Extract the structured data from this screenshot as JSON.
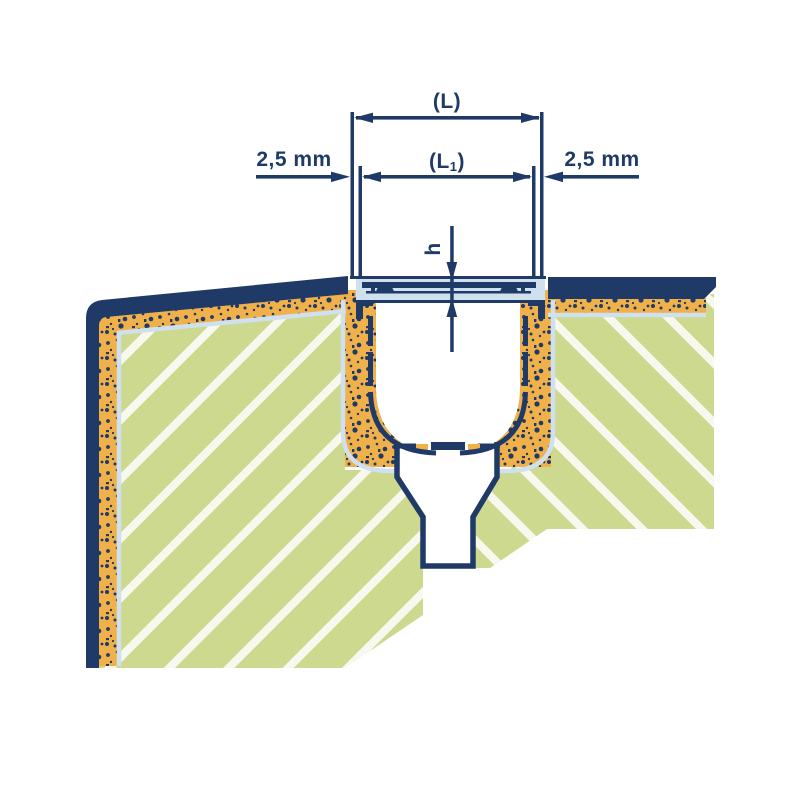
{
  "drawing": {
    "description": "Cross-section installation drawing of a drainage channel with grate set in mortar bed within hatched concrete, with funnel outlet below",
    "labels": {
      "l": "(L)",
      "l1_prefix": "(L",
      "l1_sub": "1",
      "l1_suffix": ")",
      "gap_left": "2,5 mm",
      "gap_right": "2,5 mm",
      "h": "h"
    },
    "colors": {
      "navy": "#1f3a67",
      "orange": "#f0b04a",
      "green": "#ccd98e",
      "stripe": "#f8f8ee",
      "steel": "#cfe0ee",
      "white": "#ffffff"
    }
  }
}
